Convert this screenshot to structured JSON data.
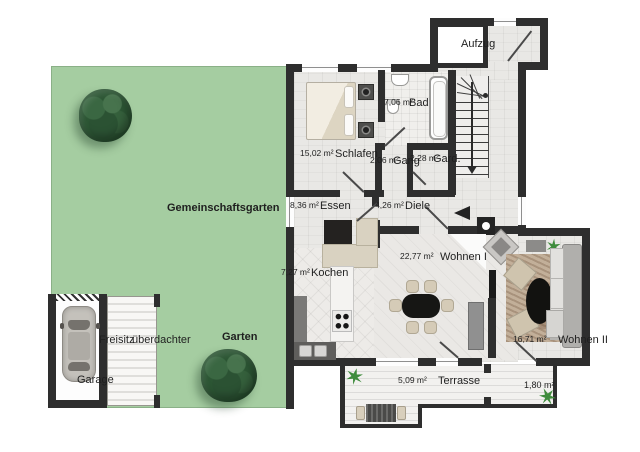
{
  "plan": {
    "elevator_label": "Aufzug",
    "outdoor": {
      "community_garden": "Gemeinschaftsgarten",
      "garden": "Garten",
      "garage": "Garage",
      "covered_seat_line1": "überdachter",
      "covered_seat_line2": "Freisitz",
      "terrace_side_area": "1,80 m²"
    },
    "rooms": [
      {
        "name": "Schlafen",
        "area": "15,02 m²"
      },
      {
        "name": "Bad",
        "area": "7,06 m²"
      },
      {
        "name": "Gang",
        "area": "2,06 m²"
      },
      {
        "name": "Gard.",
        "area": "2,28 m²"
      },
      {
        "name": "Essen",
        "area": "8,36 m²"
      },
      {
        "name": "Diele",
        "area": "4,26 m²"
      },
      {
        "name": "Kochen",
        "area": "7,27 m²"
      },
      {
        "name": "Wohnen I",
        "area": "22,77 m²"
      },
      {
        "name": "Wohnen II",
        "area": "16,71 m²"
      },
      {
        "name": "Terrasse",
        "area": "5,09 m²"
      }
    ],
    "colors": {
      "garden_green": "#a5cda1",
      "wall": "#2e2e2e",
      "plant_green": "#3f8c3d"
    }
  }
}
